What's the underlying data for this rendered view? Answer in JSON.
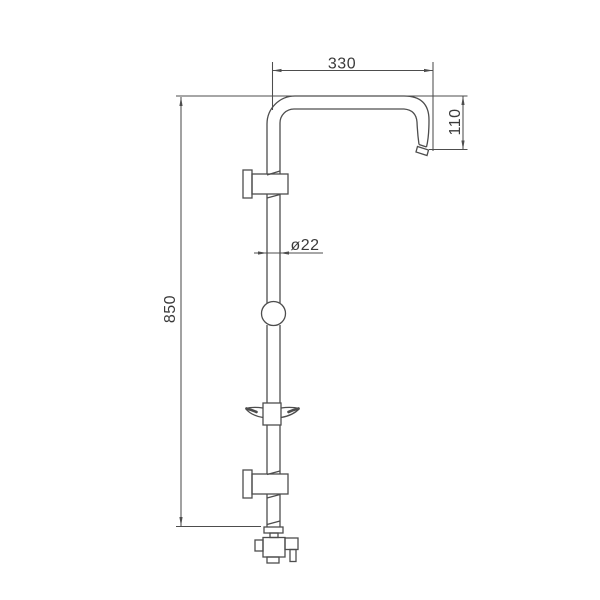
{
  "colors": {
    "line": "#4d4d4d",
    "text": "#3a3a3a",
    "background": "#ffffff"
  },
  "dimensions": {
    "arm_length": "330",
    "arm_drop": "110",
    "pipe_diameter": "ø22",
    "rail_height": "850"
  }
}
